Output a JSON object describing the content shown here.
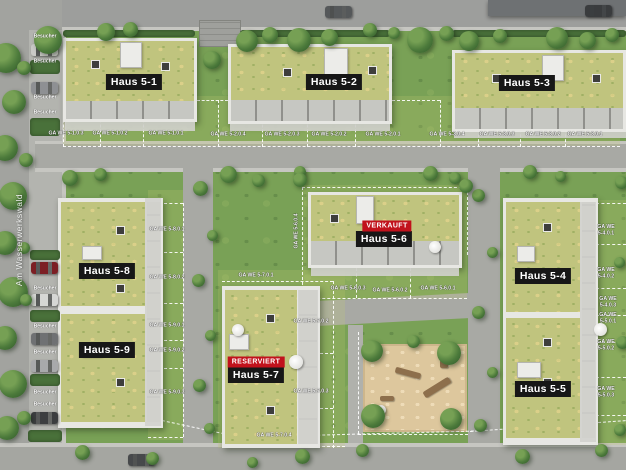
{
  "site": {
    "street_label": "Am Wasserwerkswald",
    "visitor_label": "Besucher",
    "colors": {
      "status_badge_red": "#c1121c",
      "building_label_black": "#171717",
      "grass_green": "#79a156",
      "roof_green": "#c0c47e",
      "road_gray": "#a8a9a4",
      "sand_tan": "#ddc79d"
    }
  },
  "buildings": [
    {
      "id": "haus-5-1",
      "label": "Haus 5-1",
      "status_label": ""
    },
    {
      "id": "haus-5-2",
      "label": "Haus 5-2",
      "status_label": ""
    },
    {
      "id": "haus-5-3",
      "label": "Haus 5-3",
      "status_label": ""
    },
    {
      "id": "haus-5-4",
      "label": "Haus 5-4",
      "status_label": ""
    },
    {
      "id": "haus-5-5",
      "label": "Haus 5-5",
      "status_label": ""
    },
    {
      "id": "haus-5-6",
      "label": "Haus 5-6",
      "status_label": "VERKAUFT"
    },
    {
      "id": "haus-5-7",
      "label": "Haus 5-7",
      "status_label": "RESERVIERT"
    },
    {
      "id": "haus-5-8",
      "label": "Haus 5-8",
      "status_label": ""
    },
    {
      "id": "haus-5-9",
      "label": "Haus 5-9",
      "status_label": ""
    }
  ],
  "garden_labels": [
    "GA WE 5-1.0.3",
    "GA WE 5-1.0.2",
    "GA WE 5-1.0.1",
    "GA WE 5-2.0.4",
    "GA WE 5-2.0.3",
    "GA WE 5-2.0.2",
    "GA WE 5-2.0.1",
    "GA WE 5-3.0.4",
    "GA WE 5-3.0.3",
    "GA WE 5-3.0.2",
    "GA WE 5-3.0.1",
    "GA WE 5-8.0.1",
    "GA WE 5-8.0.2",
    "GA WE 5-9.0.1",
    "GA WE 5-9.0.2",
    "GA WE 5-9.0.3",
    "GA WE 5-6.0.4",
    "GA WE 5-6.0.3",
    "GA WE 5-6.0.2",
    "GA WE 5-6.0.1",
    "GA WE 5-7.0.1",
    "GA WE 5-7.0.2",
    "GA WE 5-7.0.3",
    "GA WE 5-7.0.4",
    "GA WE 5-4.0.1",
    "GA WE 5-4.0.2",
    "GA WE 5-4.0.3",
    "GA WE 5-5.0.1",
    "GA WE 5-5.0.2",
    "GA WE 5-5.0.3"
  ]
}
